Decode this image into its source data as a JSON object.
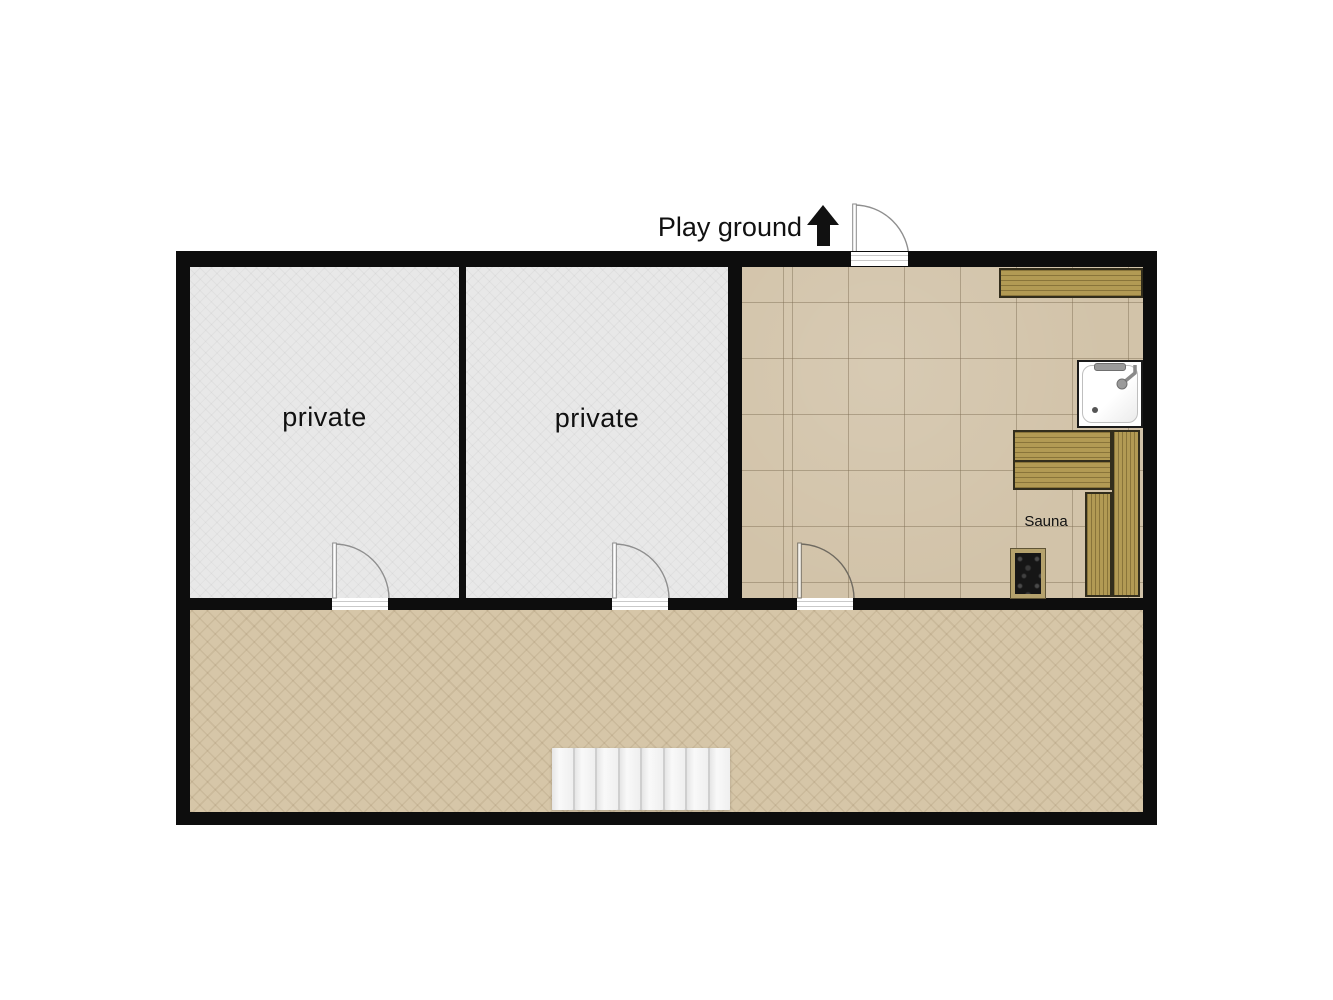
{
  "plan": {
    "annotation": {
      "playground_label": "Play ground"
    },
    "rooms": [
      {
        "id": "private-1",
        "label": "private",
        "floor": "light-gray"
      },
      {
        "id": "private-2",
        "label": "private",
        "floor": "light-gray"
      },
      {
        "id": "sauna-room",
        "label": "Sauna",
        "floor": "beige-tile"
      },
      {
        "id": "corridor",
        "label": "",
        "floor": "beige-herringbone"
      }
    ],
    "stairs": {
      "steps": 8
    },
    "doors": {
      "count": 4
    },
    "colors": {
      "wall": "#0d0d0d",
      "private_floor": "#e8e8e8",
      "tile_floor": "#d2c3a9",
      "corridor_floor": "#d6c6a8",
      "bench_wood": "#b29a54",
      "bench_border": "#322d1c",
      "heater_frame": "#b5a26d",
      "heater_stones": "#161616",
      "stairs": "#f3f3f3",
      "shower_tray": "#ffffff",
      "label_text": "#111111"
    }
  }
}
